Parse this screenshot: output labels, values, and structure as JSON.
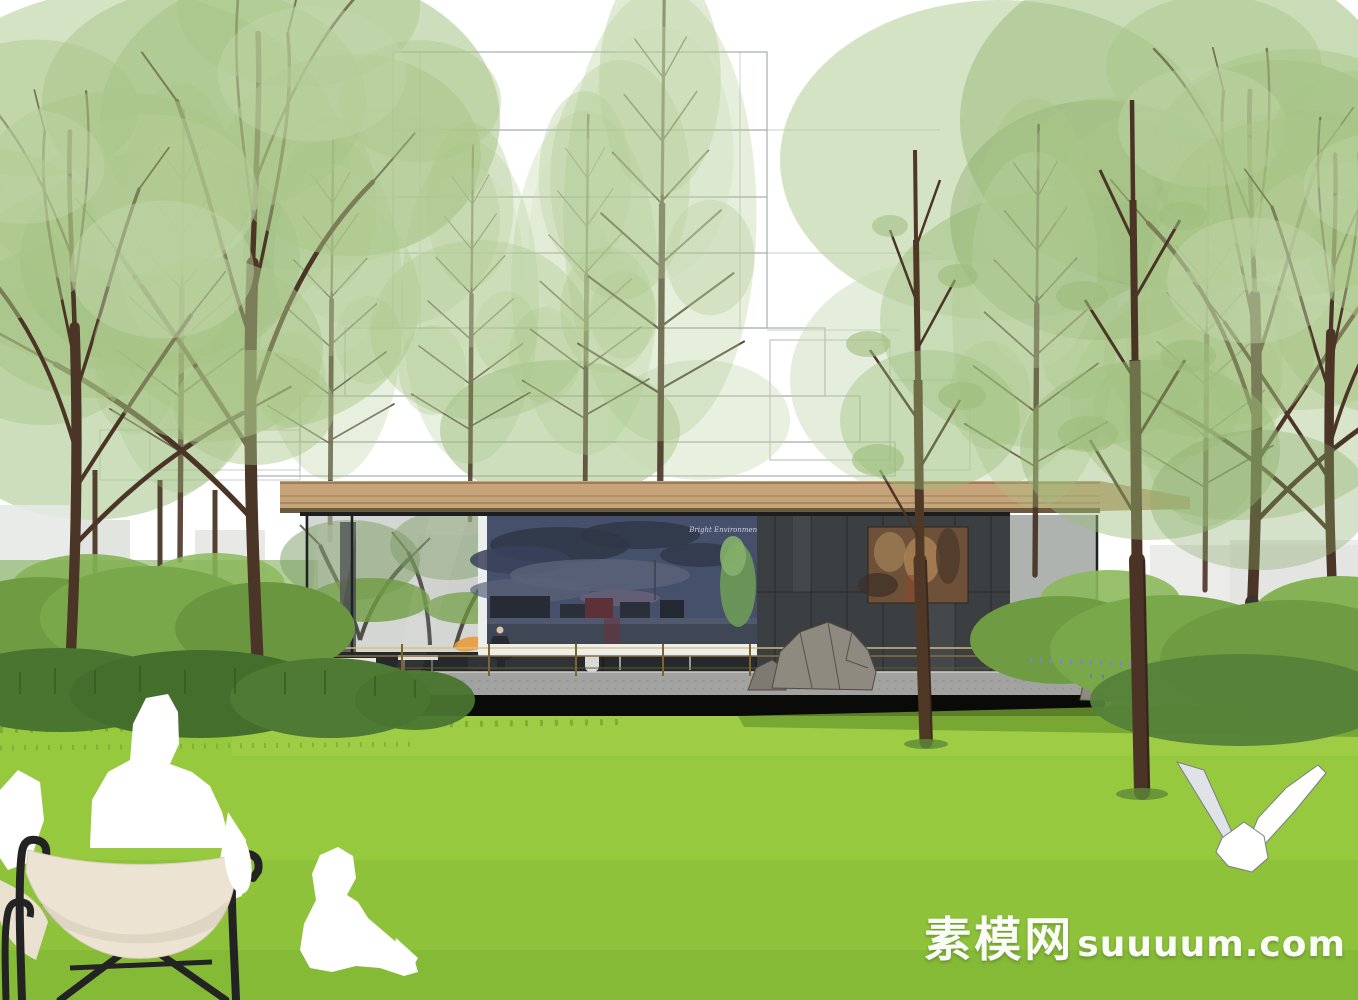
{
  "image": {
    "type": "architectural-rendering",
    "subject": "Modern glass garden pavilion with media screen in a tree grove",
    "style": "SketchUp-style render: white silhouette figures, wireframe tower massing behind trees"
  },
  "watermark": {
    "cjk": "素模网",
    "latin": "suuuum.com"
  },
  "screen": {
    "caption": "Bright Environment"
  },
  "palette": {
    "sky": "#ffffff",
    "wireframe": "#9aa09e",
    "foliage_light": "#a9c688",
    "foliage_pale": "#c3d7ac",
    "trunk": "#4a3526",
    "roof_tan": "#c6a379",
    "glass": "#aeb4ad",
    "stone_wall": "#3b3f41",
    "screen_frame": "#eceded",
    "screen_sky": "#46506a",
    "artwork_rust": "#6e5138",
    "brass_rail": "#b99a50",
    "granite": "#a2a2a0",
    "shadow_band": "#0a0a08",
    "lawn": "#97c93e",
    "lawn_shadow": "#6f9e30",
    "hedge": "#6f9c42",
    "flower_purple": "#8a7ae0",
    "figure_white": "#ffffff",
    "chair_canvas": "#ece3d2",
    "chair_frame": "#232323",
    "dress_mint": "#a8d8c5"
  },
  "scene": {
    "background": [
      "wireframe building massing",
      "sky"
    ],
    "building": [
      "tan flat roof",
      "glass curtain wall",
      "media screen with dusk city skyline",
      "dark stone wall with rust artwork",
      "brass railing",
      "granite plinth",
      "landscape rocks",
      "orange pendant lamps",
      "benches"
    ],
    "figures": [
      "white adult silhouette in sling chair",
      "white child silhouette on lawn",
      "suited visitor inside pavilion",
      "woman in mint dress",
      "white origami bird"
    ],
    "planting": [
      "metasequoia grove",
      "clipped hedge mounds",
      "purple perennial border",
      "open lawn"
    ]
  }
}
